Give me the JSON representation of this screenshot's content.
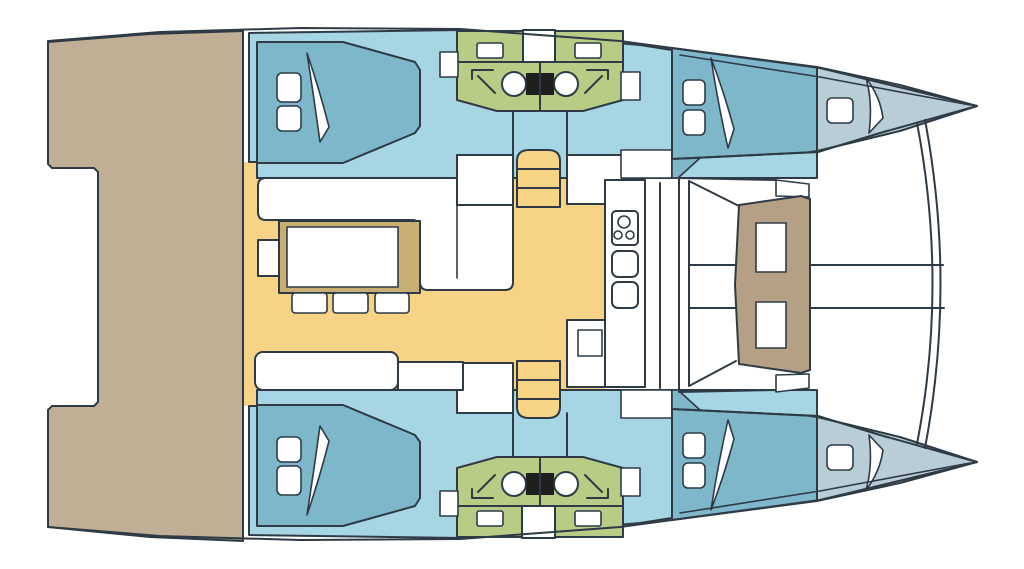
{
  "diagram": {
    "type": "catamaran-yacht-deck-plan",
    "orientation": "bow-right",
    "hull_count": 2,
    "double_bed_count": 4,
    "forepeak_berth_count": 2,
    "toilet_count": 4,
    "shower_count": 4,
    "sink_count": 6,
    "stove_burner_count": 3,
    "stair_count": 2
  },
  "colors": {
    "outline": "#2e3b46",
    "hull_white": "#ffffff",
    "cabin_blue": "#a6d5e3",
    "bed_blue": "#7eb7ca",
    "forepeak_blue": "#b9cdd6",
    "bathroom_green": "#b9cc85",
    "salon_yellow": "#f7d385",
    "deck_tan": "#c0af95",
    "table_edge_tan": "#c9ae74",
    "cockpit_table_brown": "#b5a086",
    "fixture_black": "#1f1f1f"
  }
}
